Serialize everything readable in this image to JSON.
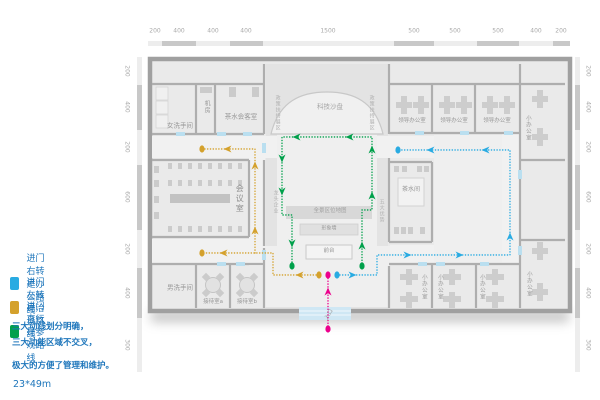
{
  "legend": {
    "items": [
      {
        "label": "进门右转是办公路线",
        "color": "#29ABE2",
        "route": "office"
      },
      {
        "label": "进门左转是洽谈路线",
        "color": "#D4A12C",
        "route": "negotiation"
      },
      {
        "label": "进门直行是参观路线",
        "color": "#00A04B",
        "route": "visit"
      }
    ],
    "notes": [
      "三大动线划分明确，",
      "三大功能区域不交叉，",
      "极大的方便了管理和维护。"
    ],
    "size_note": "23*49m"
  },
  "rulers": {
    "top": [
      "200",
      "400",
      "400",
      "400",
      "1500",
      "500",
      "500",
      "500",
      "400",
      "200"
    ],
    "left": [
      "200",
      "400",
      "200",
      "600",
      "200",
      "400",
      "300"
    ],
    "right": [
      "200",
      "400",
      "200",
      "600",
      "200",
      "400",
      "300"
    ]
  },
  "rooms": {
    "women_restroom": "女洗手间",
    "machine_room": "机房",
    "tea_reception_room": "茶水会客室",
    "tech_sand_table": "科技沙盘",
    "leader_office": "领导办公室",
    "small_office": "小办公室",
    "meeting_room": "会议室",
    "tea_room": "茶水间",
    "men_restroom": "男洗手间",
    "reception_room_a": "接待室a",
    "reception_room_b": "接待室b",
    "panorama_map": "全景区位地图",
    "image_wall": "形象墙",
    "front_desk": "前台",
    "policy_exhibit": "政策扶持展区",
    "leading_enterprise": "龙头企业",
    "five_advantages": "五大优势",
    "entrance": "入口"
  },
  "route_colors": {
    "office": "#29ABE2",
    "negotiation": "#D4A12C",
    "visit": "#00A04B",
    "entrance": "#EC008C"
  }
}
